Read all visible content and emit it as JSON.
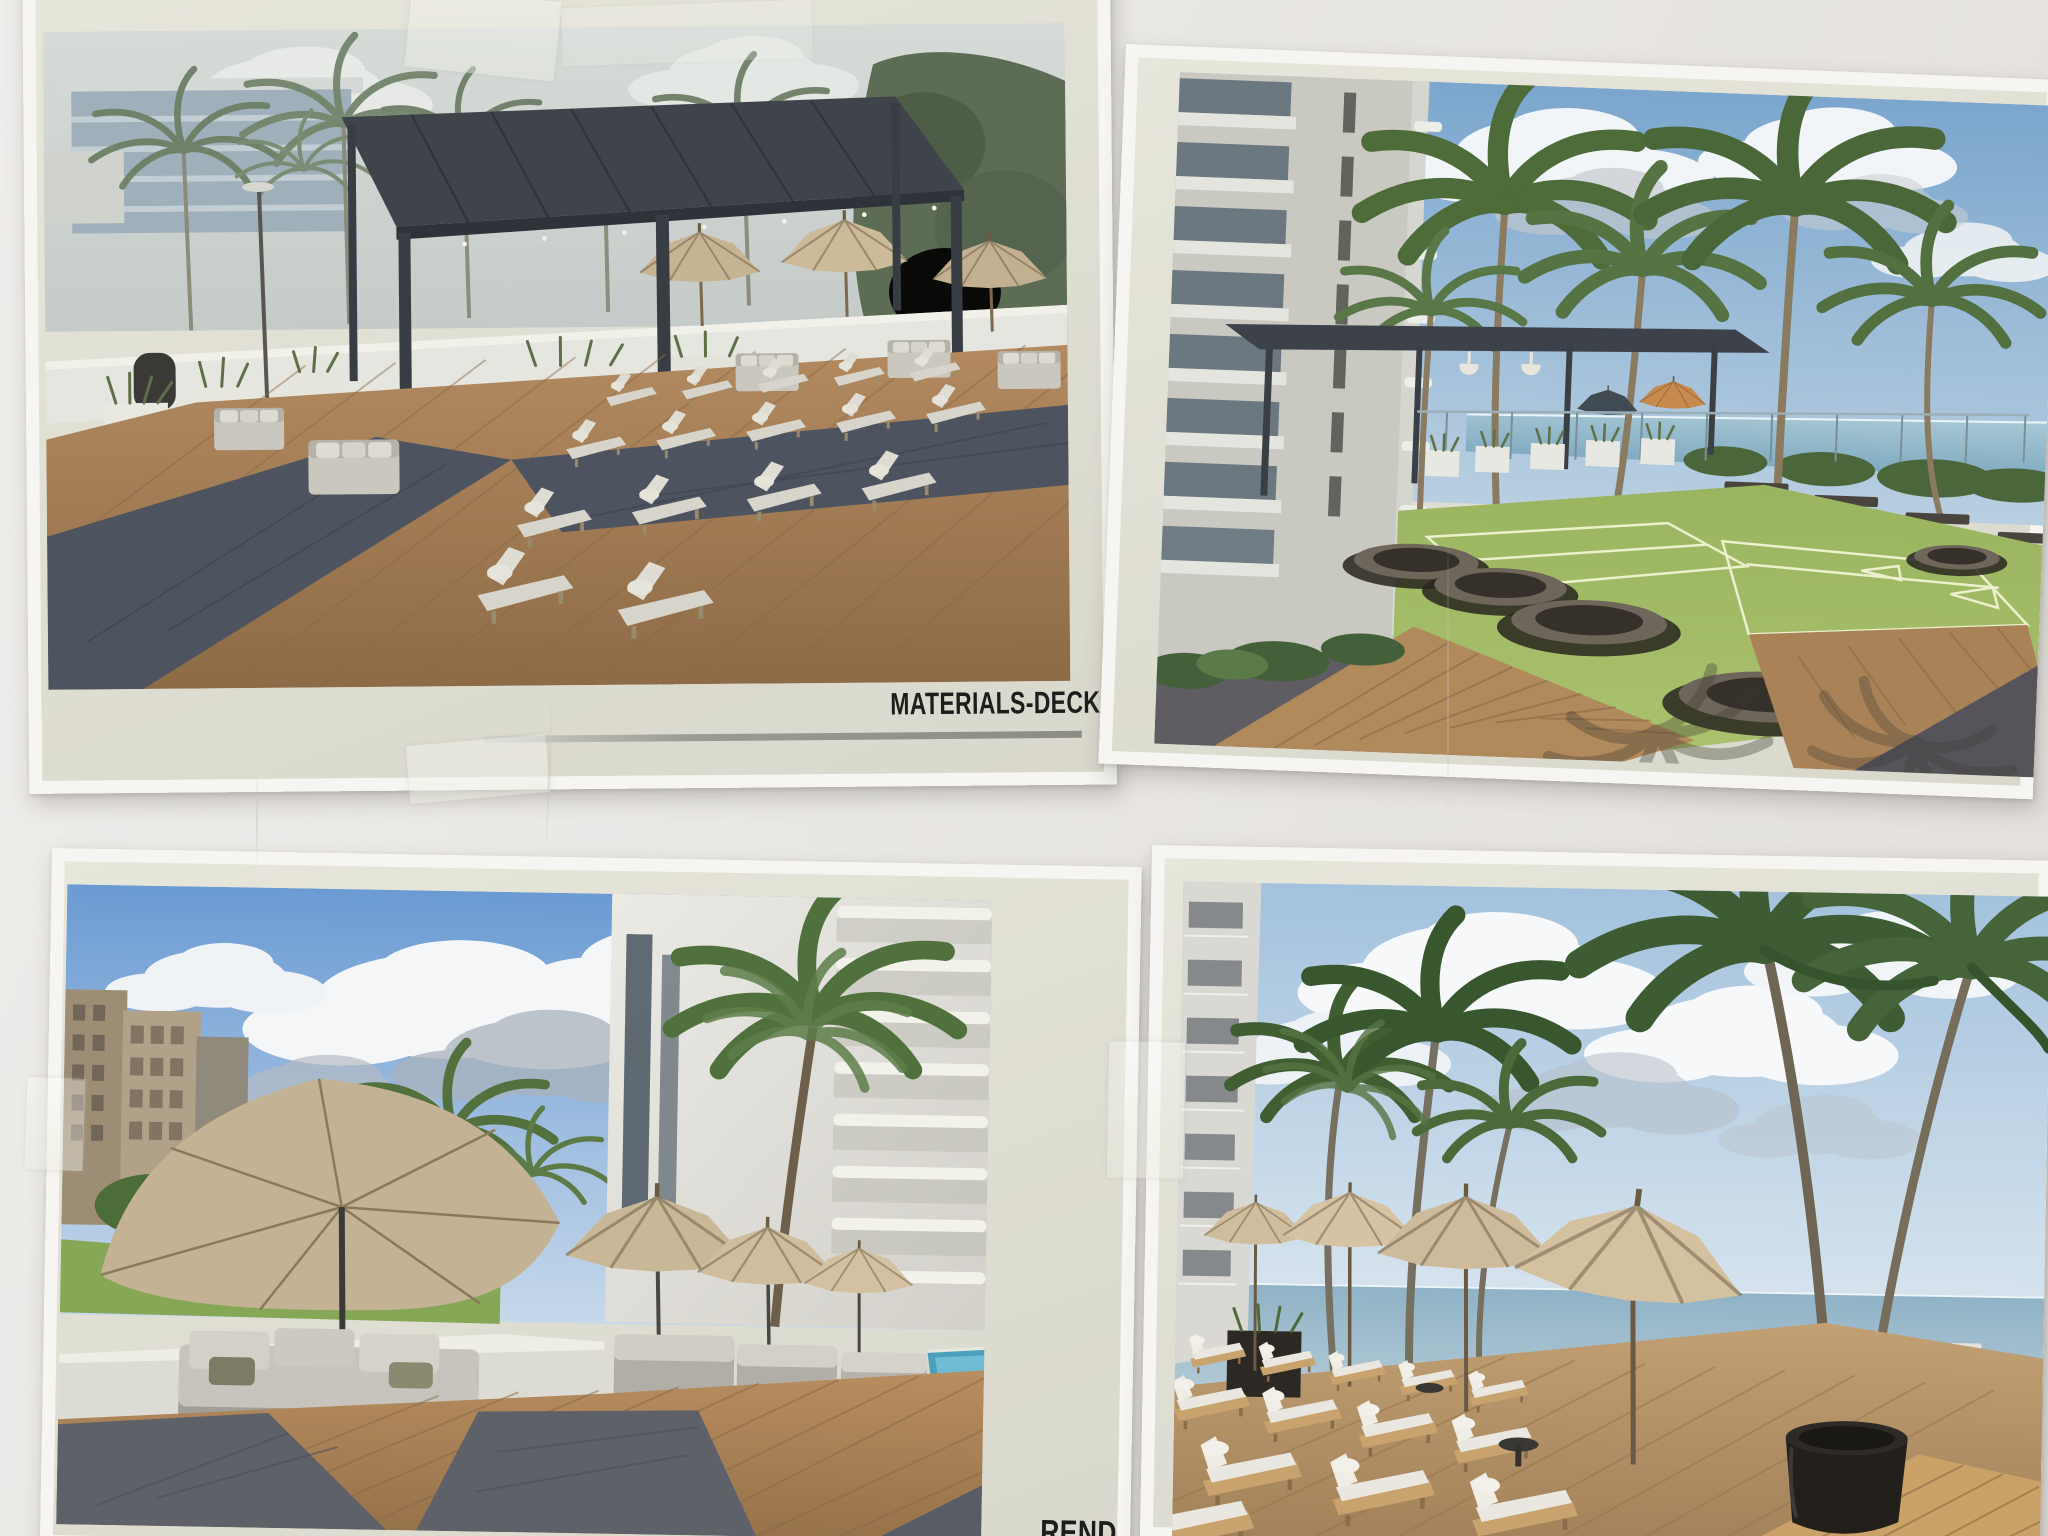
{
  "wall": {
    "color": "#e9e7e4"
  },
  "prints": {
    "materials_deck": {
      "label": "MATERIALS-DECK",
      "palette": {
        "sky": "#cdd3d0",
        "pergola": "#3f444b",
        "deck_wood": "#b38a60",
        "deck_inlay": "#4d5460",
        "cushion": "#d7d4cc",
        "umbrella": "#c6b493"
      }
    },
    "lawn_games": {
      "palette": {
        "sky": "#7ba6cd",
        "lawn": "#9ab45f",
        "ocean": "#8fb6c8",
        "deck_wood": "#b18a5c",
        "paving": "#5f5c62",
        "building": "#c9c9c2"
      }
    },
    "pool_deck": {
      "label_partial": "REND",
      "palette": {
        "sky": "#6b9bd3",
        "umbrella": "#c3b294",
        "deck_wood": "#b98e60",
        "deck_inlay": "#5f6168",
        "pool": "#4da0bc",
        "parapet": "#dddcd4"
      }
    },
    "beach_loungers": {
      "palette": {
        "sky": "#a3c2dd",
        "ocean": "#90b2c6",
        "umbrella": "#d4c1a0",
        "deck_wood": "#c2a074",
        "planter_pot": "#23201c"
      }
    }
  }
}
